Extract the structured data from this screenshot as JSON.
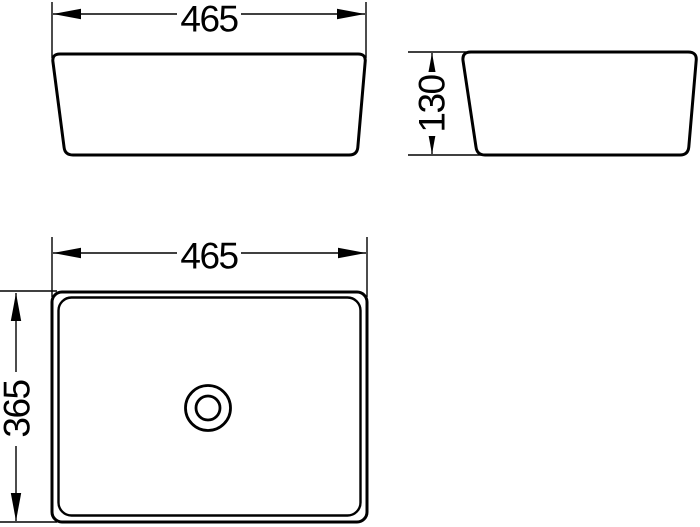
{
  "drawing": {
    "line_color": "#000000",
    "background_color": "#ffffff",
    "front_view": {
      "width_dim": "465"
    },
    "side_view": {
      "height_dim": "130"
    },
    "top_view": {
      "width_dim": "465",
      "depth_dim": "365"
    }
  }
}
